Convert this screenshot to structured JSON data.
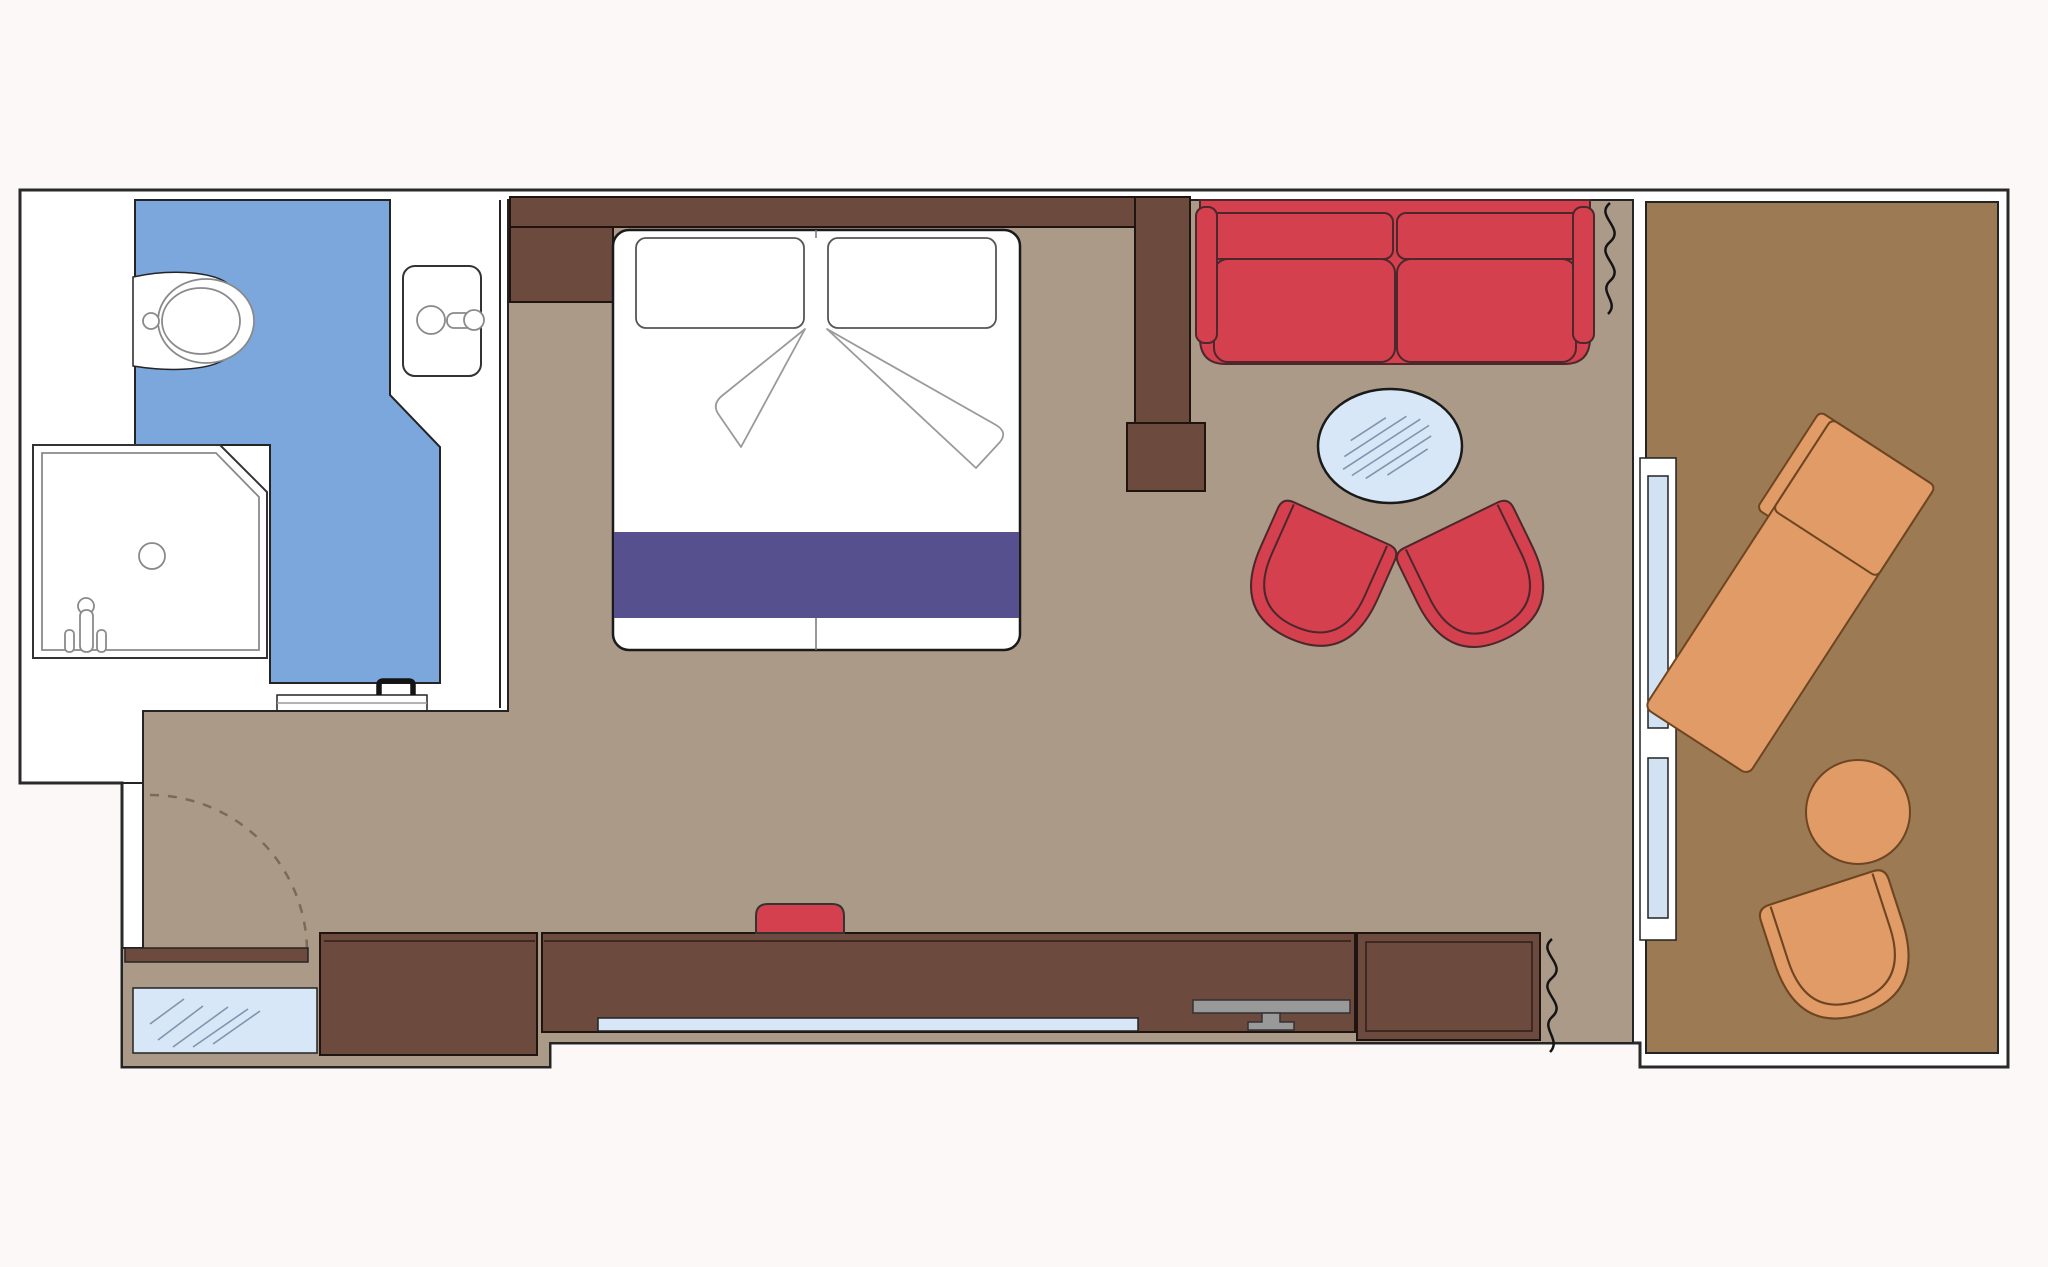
{
  "meta": {
    "type": "floor-plan",
    "description": "Top-down architectural floor plan of a cabin suite with bathroom, bedroom, living area and private balcony"
  },
  "colors": {
    "background": "#fdf8f8",
    "wall_fill": "#ffffff",
    "bathroom_floor": "#7ba7dc",
    "room_floor": "#ab9a88",
    "balcony_floor": "#9b7a54",
    "furniture_brown": "#6d4a3e",
    "upholstery_red": "#d5404f",
    "bed_runner_purple": "#57508f",
    "glass_light_blue": "#d8e7f7",
    "door_glass_blue": "#d3e2f3",
    "balcony_furniture_orange": "#e09b66",
    "tv_gray": "#999999",
    "white": "#ffffff"
  },
  "rooms": [
    {
      "id": "bathroom",
      "fixtures": [
        "toilet",
        "sink",
        "shower",
        "sliding-door-with-handles"
      ]
    },
    {
      "id": "bedroom",
      "fixtures": [
        "double-bed",
        "two-pillows",
        "folded-sheets",
        "purple-bed-runner",
        "wardrobe",
        "headboard-wall"
      ]
    },
    {
      "id": "living-area",
      "fixtures": [
        "red-sofa",
        "round-glass-coffee-table",
        "two-red-tub-chairs",
        "divider-wall",
        "desk-counter",
        "tv",
        "red-stool",
        "mirror-strip",
        "two-curtains"
      ]
    },
    {
      "id": "entry",
      "fixtures": [
        "door-swing-arc",
        "open-door-leaf",
        "glass-closet-panel"
      ]
    },
    {
      "id": "balcony",
      "fixtures": [
        "sun-lounger",
        "round-table",
        "tub-chair",
        "sliding-glass-door"
      ]
    }
  ]
}
